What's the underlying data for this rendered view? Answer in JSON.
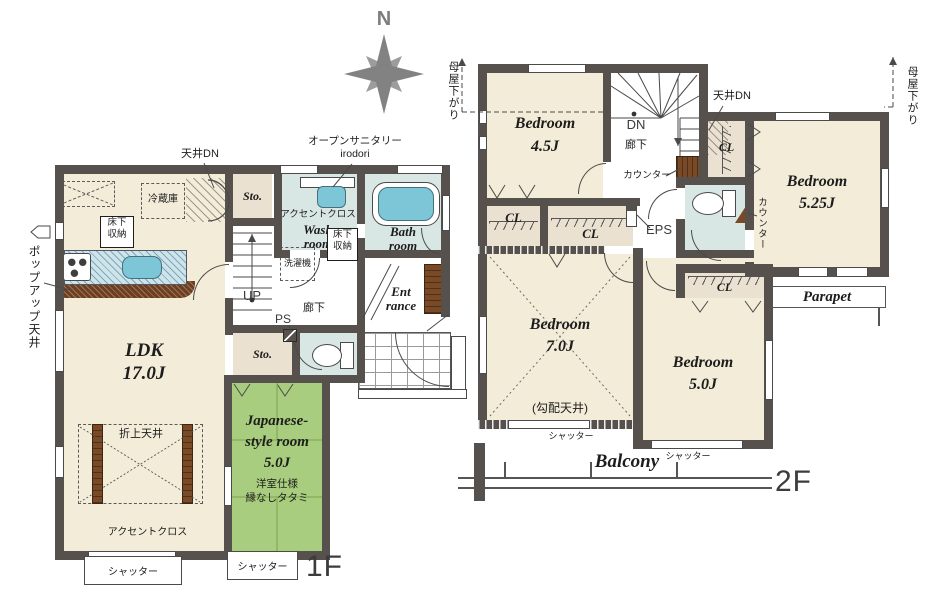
{
  "compass": {
    "north_label": "N"
  },
  "floor1": {
    "floor_label": "1F",
    "rooms": {
      "ldk": {
        "name": "LDK",
        "size": "17.0J"
      },
      "japanese_room": {
        "name_line1": "Japanese-",
        "name_line2": "style room",
        "size": "5.0J",
        "note_line1": "洋室仕様",
        "note_line2": "縁なしタタミ"
      },
      "wash_room": {
        "name_line1": "Wash",
        "name_line2": "room"
      },
      "bath_room": {
        "name_line1": "Bath",
        "name_line2": "room"
      },
      "entrance": {
        "name_line1": "Ent",
        "name_line2": "rance"
      },
      "storage": "Sto."
    },
    "labels": {
      "ceiling_down": "天井DN",
      "open_sanitary_line1": "オープンサニタリー",
      "open_sanitary_line2": "irodori",
      "refrigerator": "冷蔵庫",
      "underfloor_storage_line1": "床下",
      "underfloor_storage_line2": "収納",
      "accent_cross": "アクセントクロス",
      "washing_machine": "洗濯機",
      "up": "UP",
      "hallway": "廊下",
      "pipe_space": "PS",
      "popup_ceiling": "ポップアップ天井",
      "coffered_ceiling": "折上天井",
      "shutter": "シャッター"
    }
  },
  "floor2": {
    "floor_label": "2F",
    "rooms": {
      "bedroom_45": {
        "name": "Bedroom",
        "size": "4.5J"
      },
      "bedroom_525": {
        "name": "Bedroom",
        "size": "5.25J"
      },
      "bedroom_70": {
        "name": "Bedroom",
        "size": "7.0J",
        "note": "(勾配天井)"
      },
      "bedroom_50": {
        "name": "Bedroom",
        "size": "5.0J"
      },
      "closet": "CL",
      "balcony": "Balcony",
      "parapet": "Parapet"
    },
    "labels": {
      "down": "DN",
      "hallway": "廊下",
      "ceiling_down": "天井DN",
      "counter": "カウンター",
      "eps": "EPS",
      "moya_sagari": "母屋下がり",
      "shutter": "シャッター"
    }
  },
  "colors": {
    "wall": "#57514d",
    "room_beige": "#f2ecd8",
    "closet_beige": "#ebe1d1",
    "wet_area_blue": "#d9e7e4",
    "fixture_blue": "#7cc6d7",
    "tatami_green": "#a9cd7e",
    "wood_brown": "#7a4a26"
  }
}
